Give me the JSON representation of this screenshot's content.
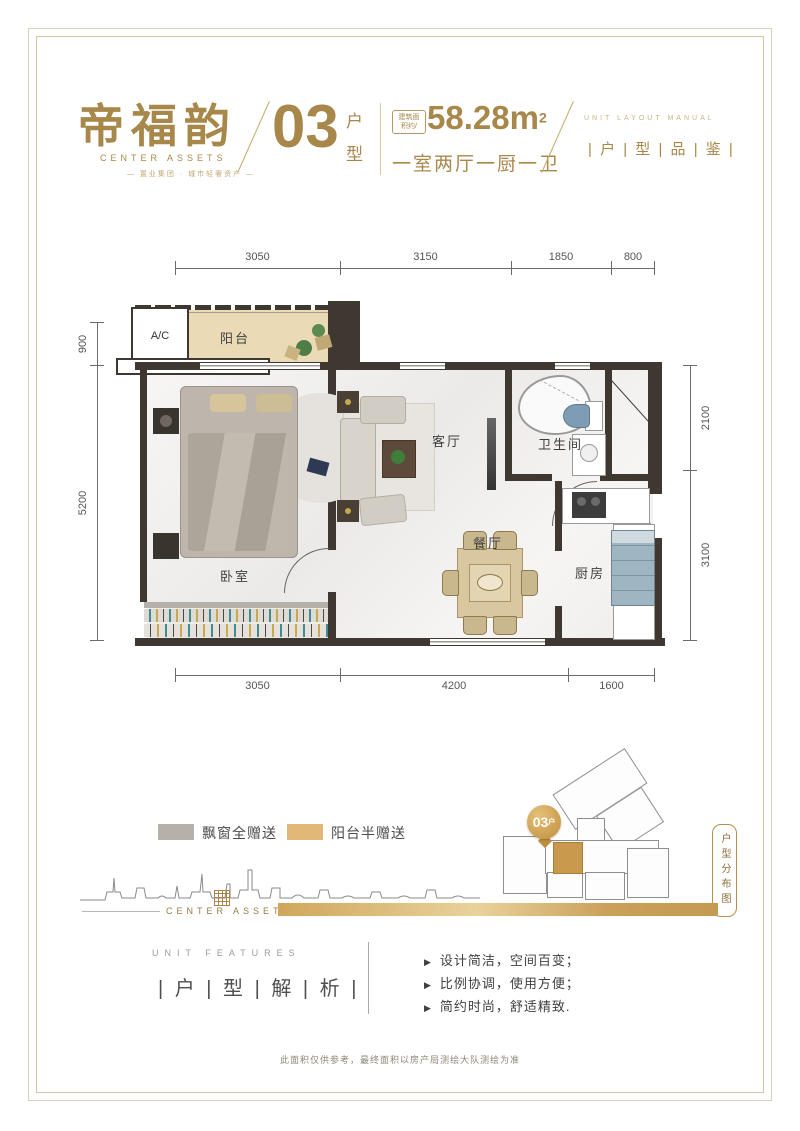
{
  "header": {
    "brand_cn": "帝福韵",
    "brand_en": "CENTER ASSETS",
    "brand_tagline": "— 置业集团 · 城市轻奢资产 —",
    "unit_no": "03",
    "unit_char_1": "户",
    "unit_char_2": "型",
    "area_badge_line1": "建筑面",
    "area_badge_line2": "积约/",
    "area_value": "58.28m",
    "area_sup": "2",
    "layout_text": "一室两厅一厨一卫",
    "series_en": "UNIT LAYOUT MANUAL",
    "series_cn": "| 户 | 型 | 品 | 鉴 |"
  },
  "floorplan": {
    "rooms": {
      "ac": "A/C",
      "balcony": "阳台",
      "bedroom": "卧室",
      "living": "客厅",
      "bathroom": "卫生间",
      "dining": "餐厅",
      "kitchen": "厨房"
    },
    "dims": {
      "top": [
        "3050",
        "3150",
        "1850",
        "800"
      ],
      "bottom": [
        "3050",
        "4200",
        "1600"
      ],
      "left": [
        "900",
        "5200"
      ],
      "right": [
        "2100",
        "3100"
      ]
    }
  },
  "legend": {
    "items": [
      {
        "label": "飘窗全赠送",
        "color": "#b5b1aa"
      },
      {
        "label": "阳台半赠送",
        "color": "#e2b878"
      }
    ]
  },
  "siteplan": {
    "marker_no": "03",
    "marker_suffix": "户",
    "panel_label": "户型分布图"
  },
  "brand_bar": {
    "logo_text": "CENTER ASSETS"
  },
  "features": {
    "title_en": "UNIT FEATURES",
    "title_cn": "| 户 | 型 | 解 | 析 |",
    "bullet_icon": "▶",
    "items": [
      "设计简洁，空间百变；",
      "比例协调，使用方便；",
      "简约时尚，舒适精致."
    ]
  },
  "footer": {
    "disclaimer": "此面积仅供参考，最终面积以房产局测绘大队测绘为准"
  },
  "colors": {
    "gold": "#a8874b",
    "gold_light": "#c9ab6e",
    "wall": "#3f3830",
    "balcony_fill": "#eadbb6",
    "legend_gray": "#b5b1aa",
    "legend_gold": "#e2b878",
    "text_gray": "#4a4a4a"
  }
}
